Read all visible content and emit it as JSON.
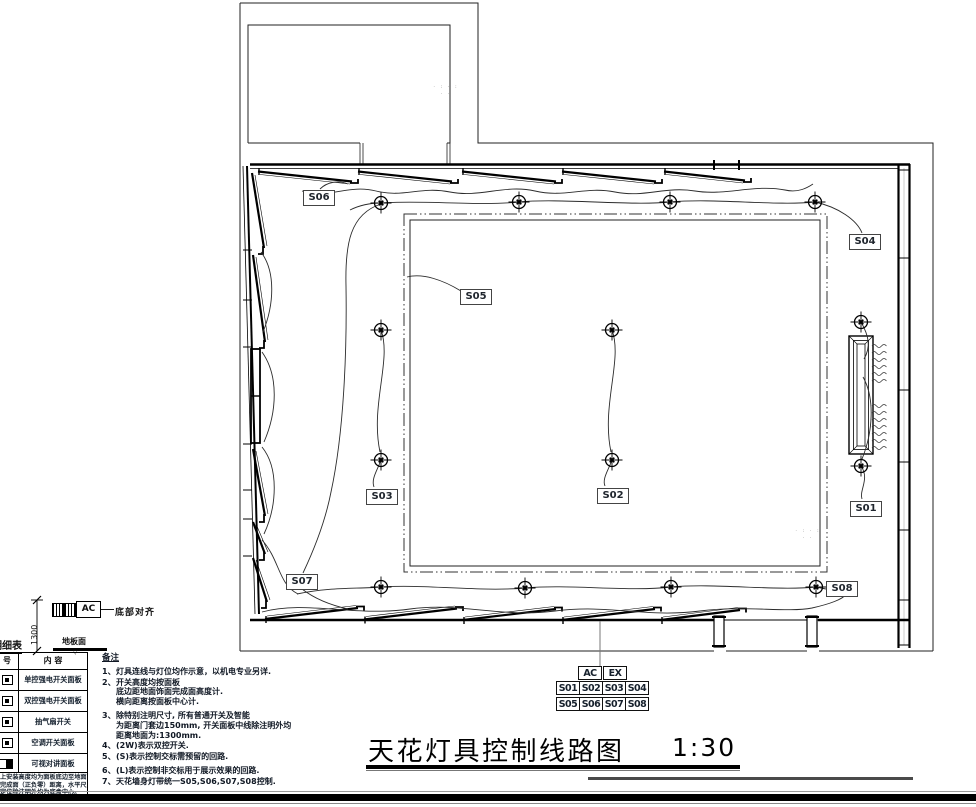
{
  "plan": {
    "switch_labels": {
      "s01": "S01",
      "s02": "S02",
      "s03": "S03",
      "s04": "S04",
      "s05": "S05",
      "s06": "S06",
      "s07": "S07",
      "s08": "S08"
    },
    "faint_annotations": {
      "upper_room": [
        "· :  · :",
        "·   ·"
      ],
      "lower_right": [
        "· :  · :",
        "·   ·"
      ]
    }
  },
  "controller": {
    "ac": "AC",
    "ex": "EX",
    "row1": [
      "S01",
      "S02",
      "S03",
      "S04"
    ],
    "row2": [
      "S05",
      "S06",
      "S07",
      "S08"
    ]
  },
  "legend": {
    "title": "明细表",
    "ac_label": "AC",
    "align_note": "底部对齐",
    "dimension": "1300",
    "floor_label": "地板面",
    "floor_mark": "▽",
    "col_symbol": "号",
    "col_content": "内 容",
    "rows": [
      "单控强电开关面板",
      "双控强电开关面板",
      "抽气扇开关",
      "空调开关面板",
      "可视对讲面板"
    ],
    "footnote_lines": [
      "上安装高度均为面板底边至地面",
      "完成面（正负零）距离，水平尺",
      "定位除注明外均为底盒中心。"
    ]
  },
  "notes": {
    "title": "备注",
    "items": [
      {
        "num": "1、",
        "lines": [
          "灯具连线与灯位均作示意，以机电专业另详."
        ]
      },
      {
        "num": "2、",
        "lines": [
          "开关高度均按面板",
          "底边距地面饰面完成面高度计.",
          "横向距离按面板中心计."
        ]
      },
      {
        "num": "3、",
        "lines": [
          "除特别注明尺寸, 所有普通开关及智能",
          "为距离门套边150mm, 开关面板中线除注明外均",
          "距离地面为:1300mm."
        ]
      },
      {
        "num": "4、",
        "lines": [
          "(2W)表示双控开关."
        ]
      },
      {
        "num": "5、",
        "lines": [
          "(S)表示控制交标需预留的回路."
        ]
      },
      {
        "num": "6、",
        "lines": [
          "(L)表示控制非交标用于展示效果的回路."
        ]
      },
      {
        "num": "7、",
        "lines": [
          "天花墙身灯带统一S05,S06,S07,S08控制."
        ]
      }
    ]
  },
  "title_block": {
    "title": "天花灯具控制线路图",
    "scale": "1:30"
  }
}
